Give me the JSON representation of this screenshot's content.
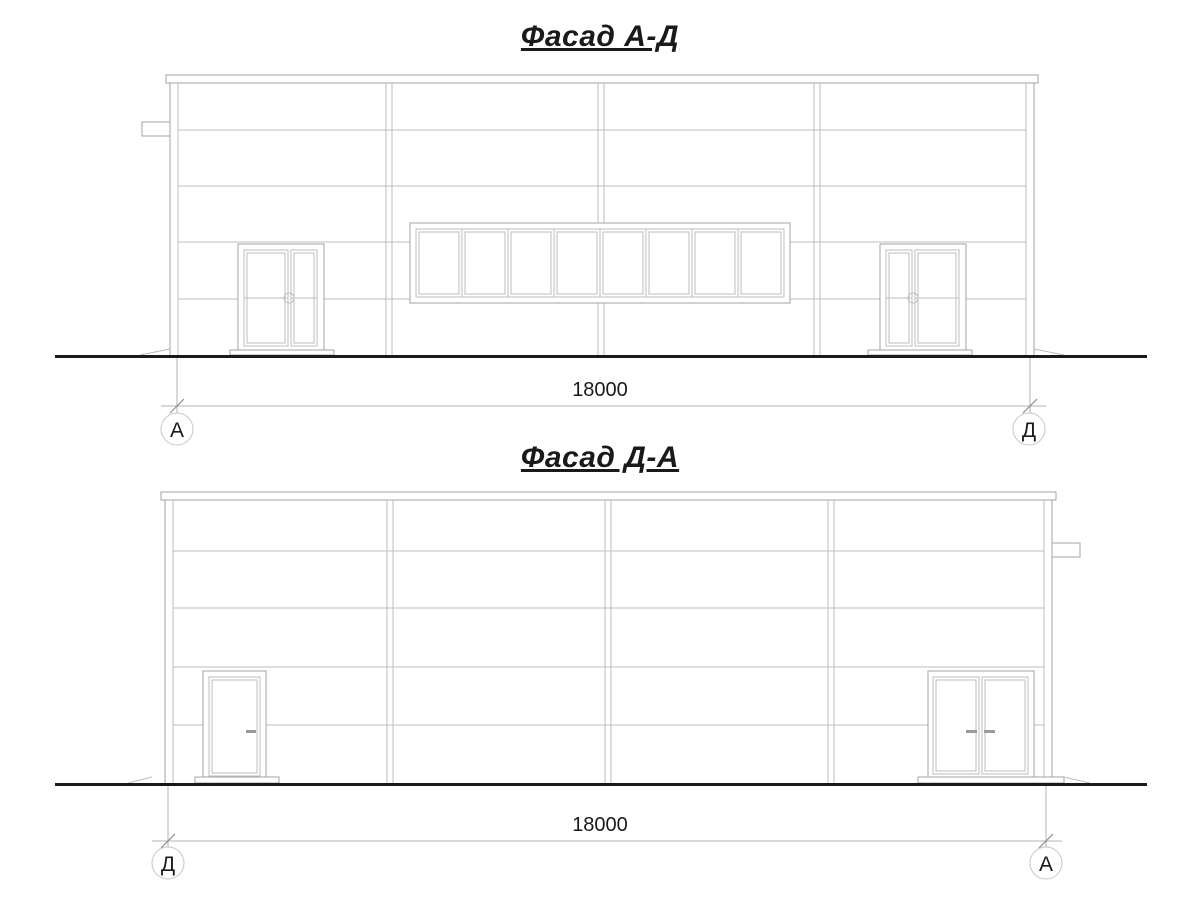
{
  "drawing": {
    "facade_ad": {
      "title": "Фасад А-Д",
      "dimension_label": "18000",
      "axis_left_label": "А",
      "axis_right_label": "Д"
    },
    "facade_da": {
      "title": "Фасад Д-А",
      "dimension_label": "18000",
      "axis_left_label": "Д",
      "axis_right_label": "А"
    },
    "colors": {
      "line": "#a3a3a3",
      "light_line": "#bdbdbd",
      "ground": "#1a1a1a",
      "text": "#1a1a1a"
    }
  }
}
